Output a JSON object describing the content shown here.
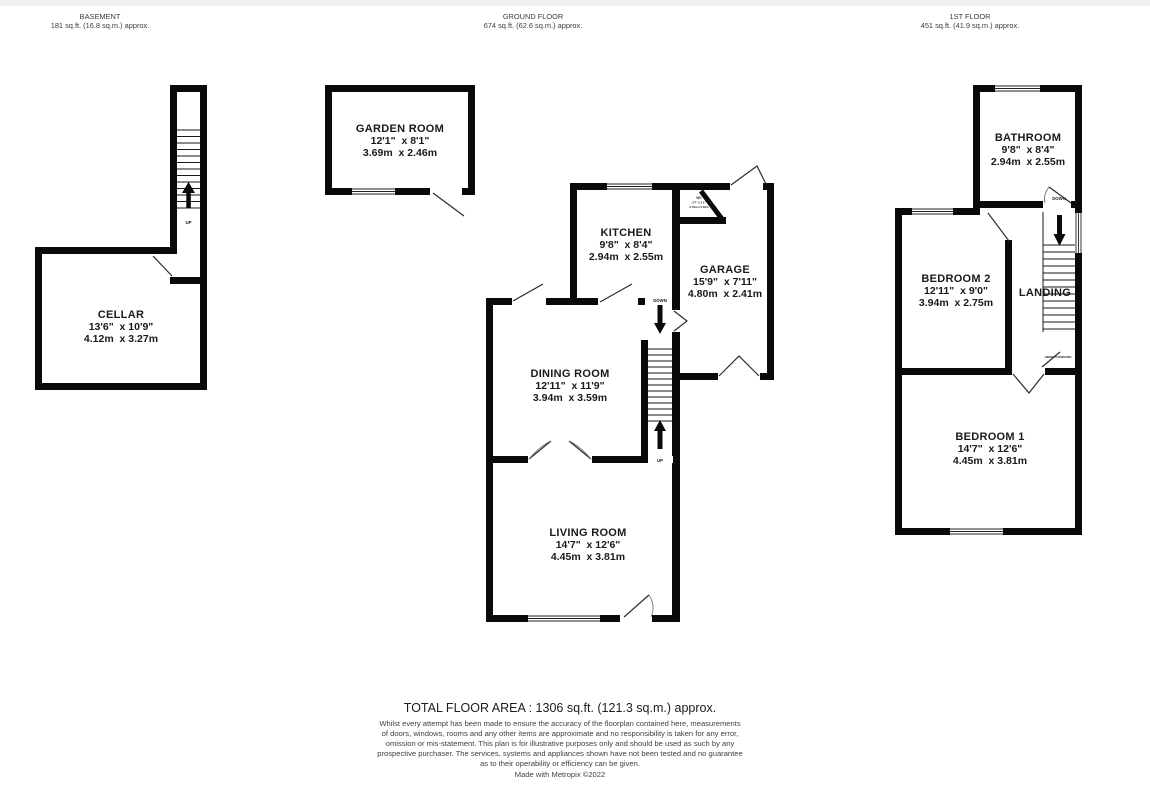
{
  "colors": {
    "wall": "#0a0a0a",
    "text": "#1a1a1a",
    "muted_text": "#3f3f3f",
    "top_strip": "#f0f0f0",
    "background": "#ffffff"
  },
  "headers": {
    "basement": {
      "title": "BASEMENT",
      "area": "181 sq.ft. (16.8 sq.m.) approx."
    },
    "ground": {
      "title": "GROUND FLOOR",
      "area": "674 sq.ft. (62.6 sq.m.) approx."
    },
    "first": {
      "title": "1ST FLOOR",
      "area": "451 sq.ft. (41.9 sq.m.) approx."
    }
  },
  "rooms": {
    "cellar": {
      "name": "CELLAR",
      "imperial": "13'6\"  x 10'9\"",
      "metric": "4.12m  x 3.27m"
    },
    "garden_room": {
      "name": "GARDEN ROOM",
      "imperial": "12'1\"  x 8'1\"",
      "metric": "3.69m  x 2.46m"
    },
    "kitchen": {
      "name": "KITCHEN",
      "imperial": "9'8\"  x 8'4\"",
      "metric": "2.94m  x 2.55m"
    },
    "wc": {
      "name": "WC",
      "imperial": "2'7\" x 2'1\"",
      "metric": "0.79m x 0.63m"
    },
    "garage": {
      "name": "GARAGE",
      "imperial": "15'9\"  x 7'11\"",
      "metric": "4.80m  x 2.41m"
    },
    "dining_room": {
      "name": "DINING ROOM",
      "imperial": "12'11\"  x 11'9\"",
      "metric": "3.94m  x 3.59m"
    },
    "living_room": {
      "name": "LIVING ROOM",
      "imperial": "14'7\"  x 12'6\"",
      "metric": "4.45m  x 3.81m"
    },
    "bathroom": {
      "name": "BATHROOM",
      "imperial": "9'8\"  x 8'4\"",
      "metric": "2.94m  x 2.55m"
    },
    "bedroom2": {
      "name": "BEDROOM 2",
      "imperial": "12'11\"  x 9'0\"",
      "metric": "3.94m  x 2.75m"
    },
    "bedroom1": {
      "name": "BEDROOM 1",
      "imperial": "14'7\"  x 12'6\"",
      "metric": "4.45m  x 3.81m"
    },
    "landing": {
      "name": "LANDING"
    },
    "airing_cupboard": {
      "name": "AIRING CUPBOARD"
    }
  },
  "stair_labels": {
    "up": "UP",
    "down": "DOWN"
  },
  "footer": {
    "total": "TOTAL FLOOR AREA : 1306 sq.ft. (121.3 sq.m.) approx.",
    "disclaimer_lines": [
      "Whilst every attempt has been made to ensure the accuracy of the floorplan contained here, measurements",
      "of doors, windows, rooms and any other items are approximate and no responsibility is taken for any error,",
      "omission or mis-statement. This plan is for illustrative purposes only and should be used as such by any",
      "prospective purchaser. The services, systems and appliances shown have not been tested and no guarantee",
      "as to their operability or efficiency can be given."
    ],
    "credit": "Made with Metropix ©2022"
  }
}
